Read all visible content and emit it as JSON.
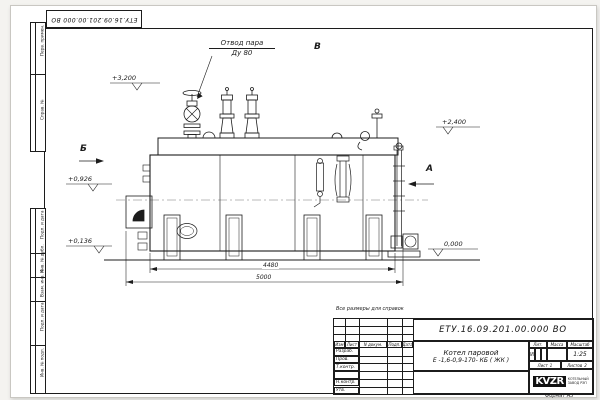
{
  "colors": {
    "line": "#1c1c1c",
    "sheet": "#ffffff"
  },
  "sheet": {
    "top_stamp": "ЕТУ.16.09.201.00.000  ВО",
    "reference_note": "Все размеры для справок",
    "format_note": "Формат А3"
  },
  "margin_cells": [
    "Перв. примен.",
    "Справ. №",
    "Подп. и дата",
    "Инв. № дубл.",
    "Взам. инв. №",
    "Подп. и дата",
    "Инв. № подл."
  ],
  "drawing": {
    "callout": {
      "line1": "Отвод пара",
      "line2": "Ду 80"
    },
    "markers": {
      "b": "Б",
      "v": "В",
      "a": "А"
    },
    "elevations": {
      "top": "+3,200",
      "right": "+2,400",
      "mid": "+0,926",
      "low": "+0,136",
      "zero": "0,000"
    },
    "dimensions": {
      "inner": "4480",
      "outer": "5000"
    }
  },
  "title_block": {
    "doc_number": "ЕТУ.16.09.201.00.000  ВО",
    "product_line1": "Котел паровой",
    "product_line2": "Е -1,6-0,9-170- КБ ( ЖК )",
    "columns": [
      "Изм",
      "Лист",
      "N докум.",
      "Подп.",
      "Дата"
    ],
    "rows": [
      "Разраб.",
      "Пров.",
      "Т.контр.",
      "",
      "Н.контр.",
      "Утв."
    ],
    "lit_label": "Лит.",
    "mass_label": "Масса",
    "scale_label": "Масштаб",
    "lit_value": "И",
    "scale_value": "1:25",
    "sheet_label": "Лист",
    "sheet_value": "1",
    "sheets_label": "Листов",
    "sheets_value": "2",
    "logo": "KVZR",
    "logo_caption1": "КОТЕЛЬНЫЙ",
    "logo_caption2": "ЗАВОД РЭП"
  }
}
